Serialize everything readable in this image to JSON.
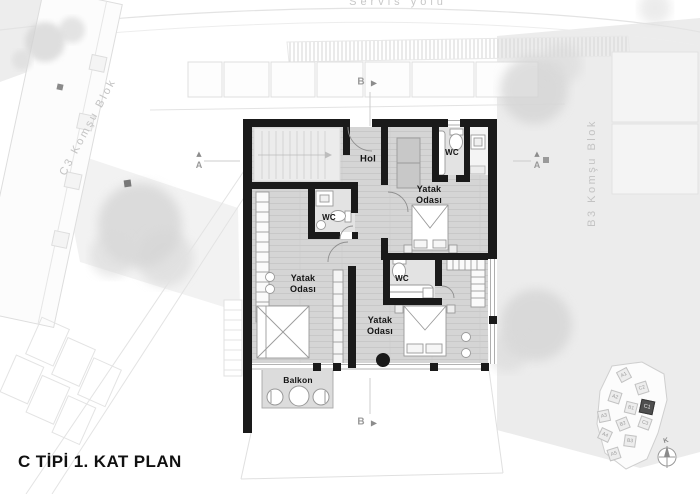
{
  "title": "C TİPİ 1. KAT PLAN",
  "site": {
    "road": "Servis yolu",
    "block_left": "C3 Komşu Blok",
    "block_right": "B3 Komşu Blok"
  },
  "rooms": {
    "hall": "Hol",
    "bedroom_top": "Yatak\nOdası",
    "bedroom_left": "Yatak\nOdası",
    "bedroom_bottom": "Yatak\nOdası",
    "wc_top": "WC",
    "wc_left": "WC",
    "wc_bottom": "WC",
    "balcony": "Balkon"
  },
  "sections": {
    "a": "A",
    "b": "B"
  },
  "icons": {
    "triangle_right": "▶",
    "triangle_up": "▲"
  },
  "keyplan": {
    "compass_north": "K",
    "highlight_block": {
      "label": "C1"
    },
    "blocks": [
      {
        "label": "A1"
      },
      {
        "label": "A2"
      },
      {
        "label": "A3"
      },
      {
        "label": "A4"
      },
      {
        "label": "A5"
      },
      {
        "label": "B1"
      },
      {
        "label": "B2"
      },
      {
        "label": "B3"
      },
      {
        "label": "C2"
      },
      {
        "label": "C3"
      }
    ]
  },
  "colors": {
    "wall": "#1a1a1a",
    "floor": "#d5d5d5",
    "site_gray": "#ececec"
  }
}
